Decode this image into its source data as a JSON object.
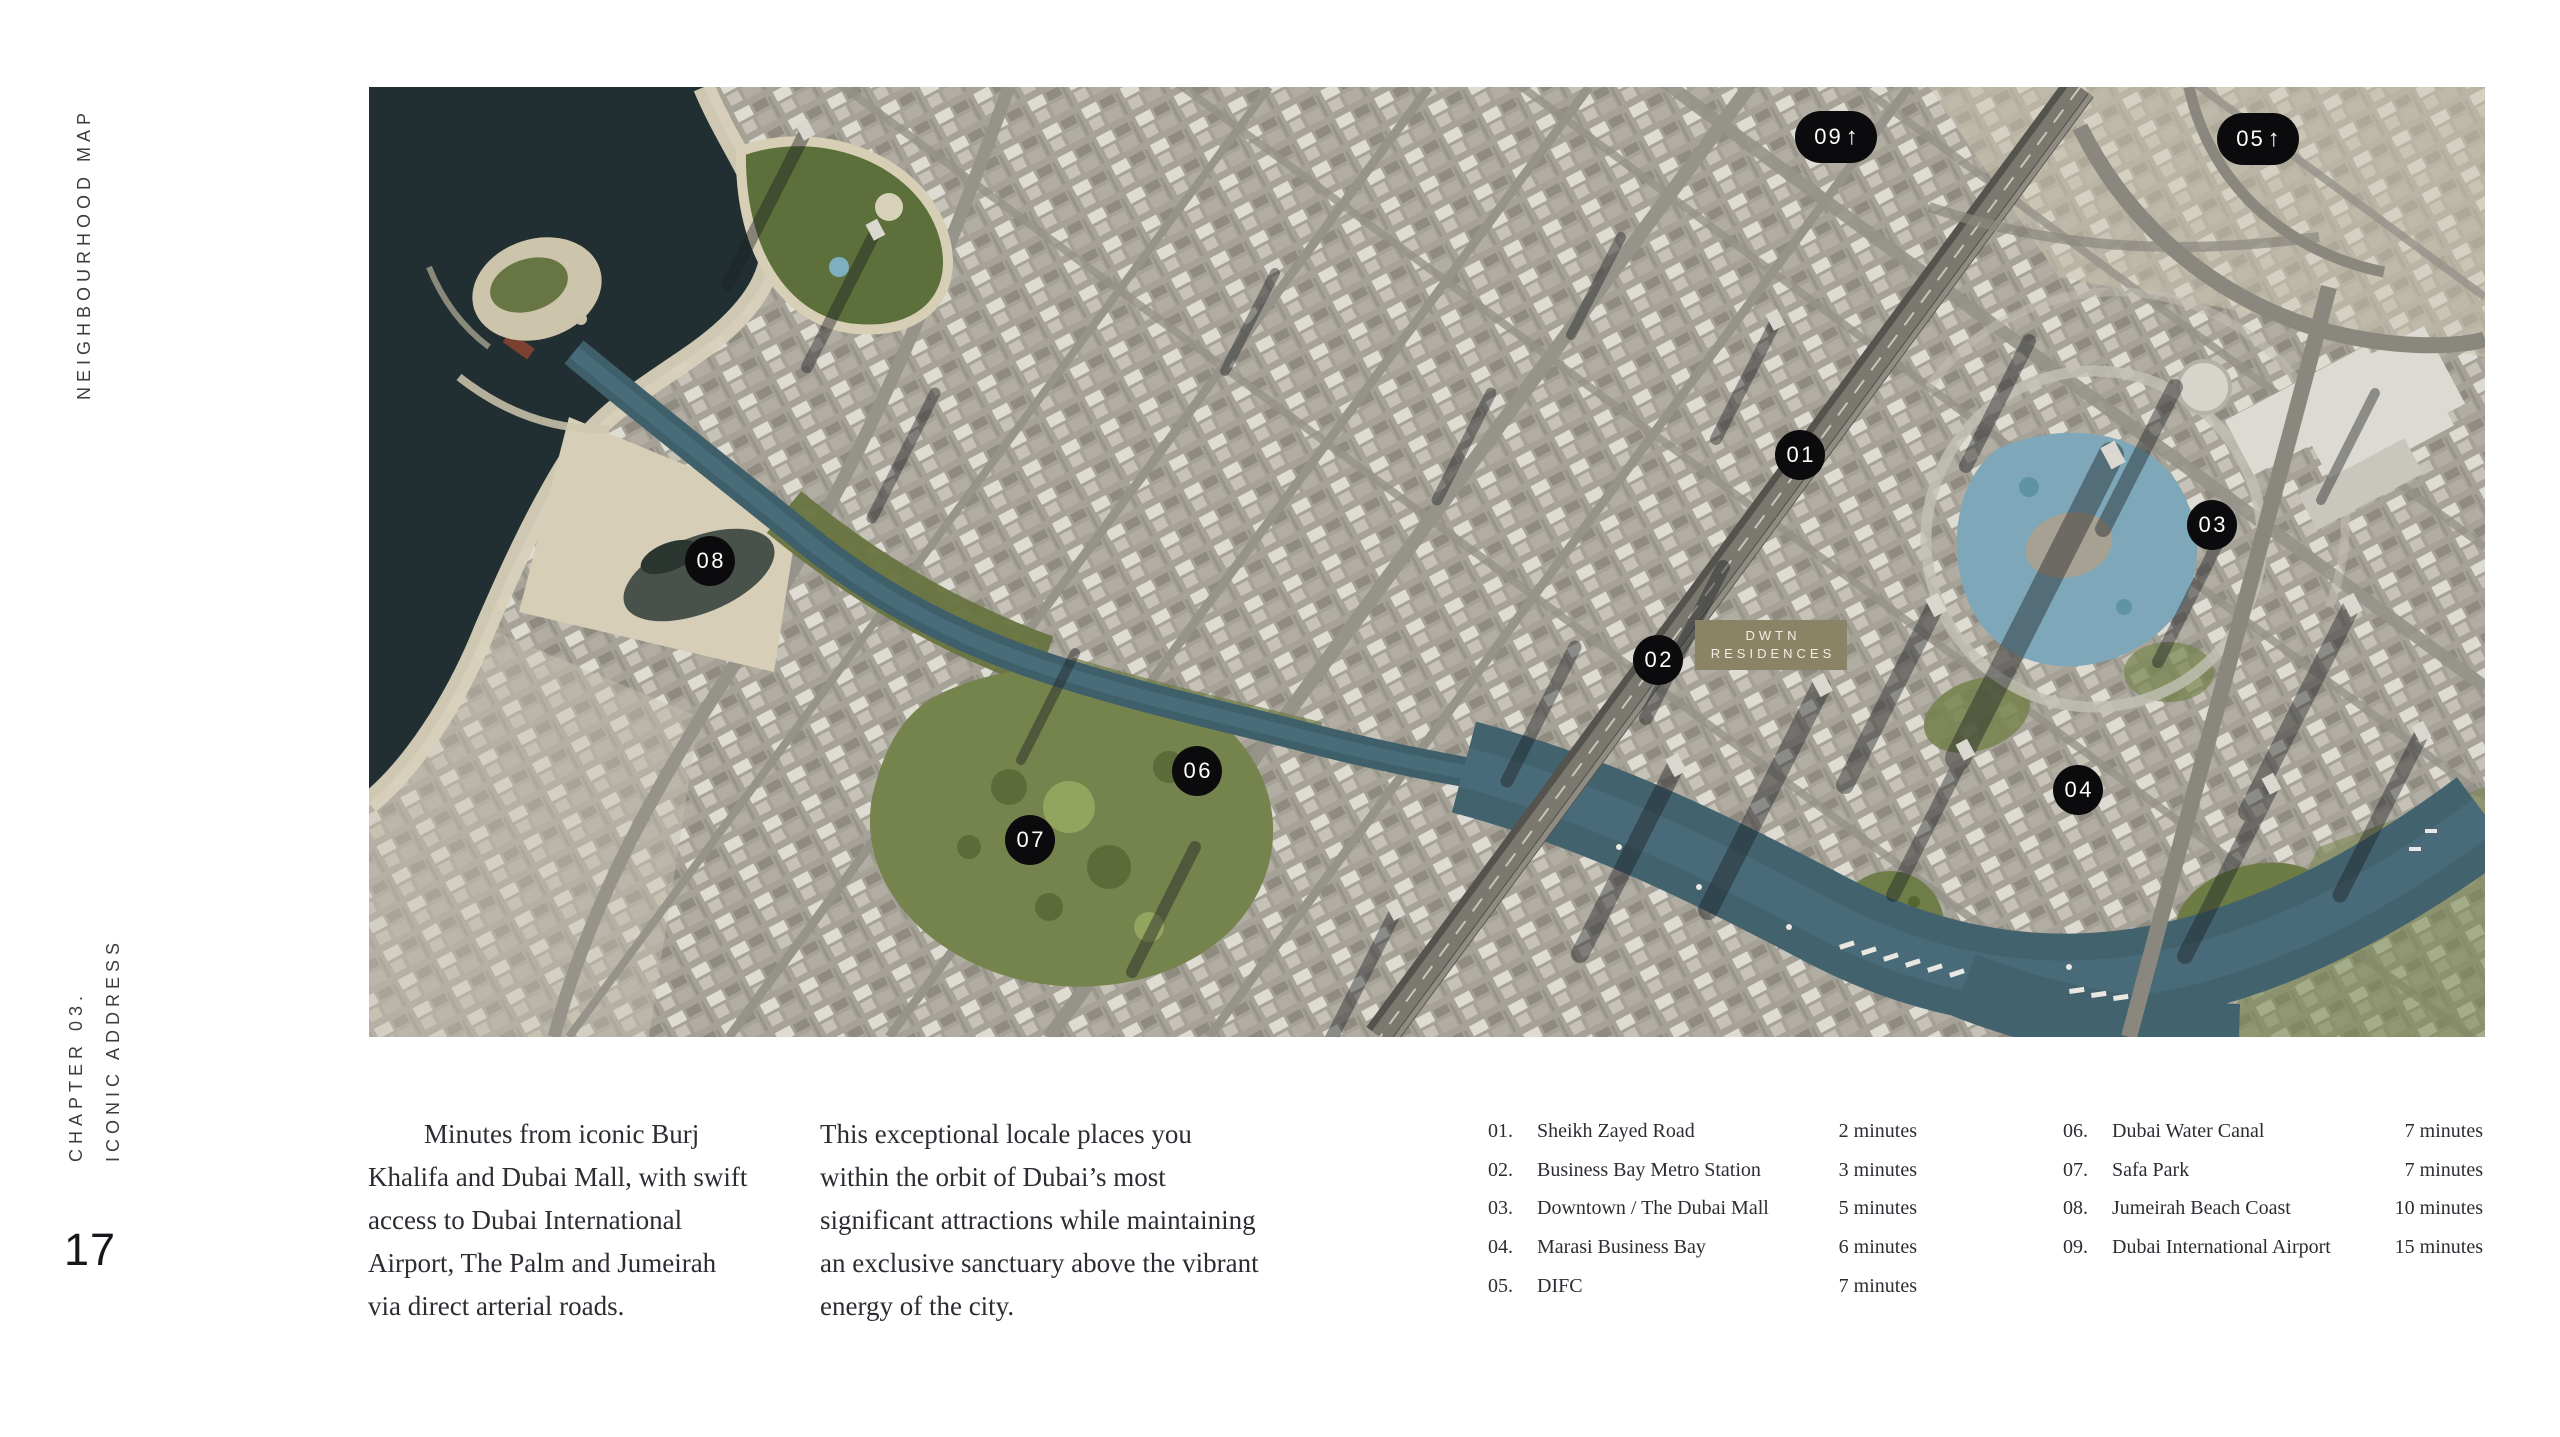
{
  "page_number": "17",
  "sidebar": {
    "section_label": "NEIGHBOURHOOD MAP",
    "chapter_label": "CHAPTER 03.",
    "chapter_sublabel": "ICONIC ADDRESS"
  },
  "map": {
    "property_label": {
      "line1": "DWTN",
      "line2": "RESIDENCES"
    },
    "arrow_glyph": "↑",
    "markers": [
      {
        "label": "01"
      },
      {
        "label": "02"
      },
      {
        "label": "03"
      },
      {
        "label": "04"
      },
      {
        "label": "05"
      },
      {
        "label": "06"
      },
      {
        "label": "07"
      },
      {
        "label": "08"
      },
      {
        "label": "09"
      }
    ]
  },
  "intro": {
    "p1_lines": [
      "Minutes from iconic Burj",
      "Khalifa and Dubai Mall, with swift",
      "access to Dubai International",
      "Airport, The Palm and Jumeirah",
      "via direct arterial roads."
    ],
    "p2_lines": [
      "This exceptional locale places you",
      "within the orbit of Dubai’s most",
      "significant attractions while maintaining",
      "an exclusive sanctuary above the vibrant",
      "energy of the city."
    ]
  },
  "legend": {
    "col1": [
      {
        "num": "01.",
        "name": "Sheikh Zayed Road",
        "time": "2 minutes"
      },
      {
        "num": "02.",
        "name": "Business Bay Metro Station",
        "time": "3 minutes"
      },
      {
        "num": "03.",
        "name": "Downtown / The Dubai Mall",
        "time": "5 minutes"
      },
      {
        "num": "04.",
        "name": "Marasi Business Bay",
        "time": "6 minutes"
      },
      {
        "num": "05.",
        "name": "DIFC",
        "time": "7 minutes"
      }
    ],
    "col2": [
      {
        "num": "06.",
        "name": "Dubai Water Canal",
        "time": "7 minutes"
      },
      {
        "num": "07.",
        "name": "Safa Park",
        "time": "7 minutes"
      },
      {
        "num": "08.",
        "name": "Jumeirah Beach Coast",
        "time": "10 minutes"
      },
      {
        "num": "09.",
        "name": "Dubai International Airport",
        "time": "15 minutes"
      }
    ]
  },
  "colors": {
    "marker_bg": "#0b0b0d",
    "property_label_bg": "#8b8365",
    "sea": "#222f32"
  }
}
